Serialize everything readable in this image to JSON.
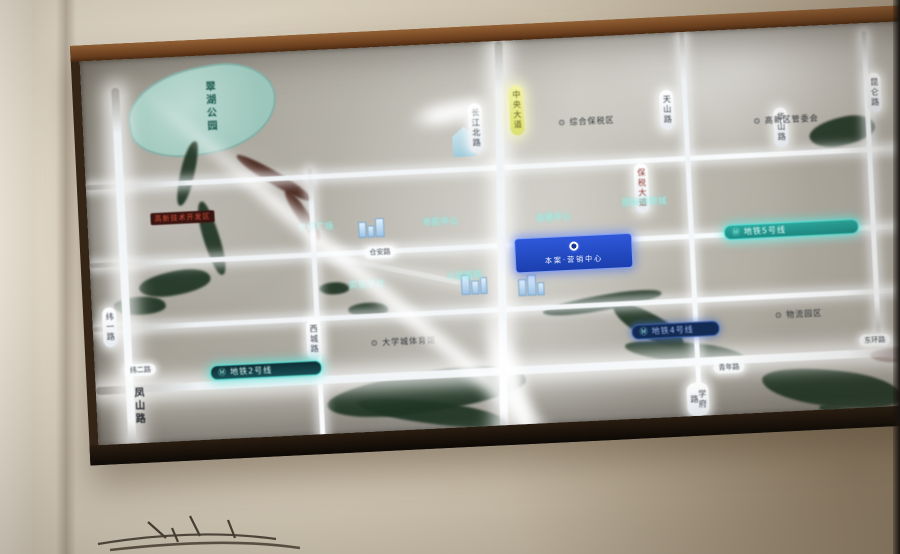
{
  "scene": {
    "type": "photo of an illuminated real-estate location map board in a wooden frame on a beige wall",
    "colors": {
      "wall": "#cfc5b2",
      "frame_wood": "#7b4b26",
      "map_base": "#b2afa6",
      "road_glow": "#f7f9fb",
      "water_green": "#213524",
      "river_red": "#45231a",
      "lake_teal": "#a9cfc5",
      "metro_teal": "#2ba79d",
      "metro_navy": "#132a52",
      "sign_blue": "#1b3fae",
      "capsule_yellow": "#e8e87a"
    }
  },
  "map": {
    "lake_label": "翠湖公园",
    "street_label_vertical": "凤山路",
    "red_banner": "高新技术开发区",
    "project_sign": {
      "icon": "ring-logo",
      "text": "本案·营销中心"
    },
    "metro_pills": [
      {
        "icon": "Ⓜ",
        "text": "地铁2号线"
      },
      {
        "icon": "Ⓜ",
        "text": "地铁5号线"
      },
      {
        "icon": "Ⓜ",
        "text": "地铁4号线"
      }
    ],
    "road_capsules": [
      {
        "text": "长江北路"
      },
      {
        "text": "中央大道"
      },
      {
        "text": "天山路"
      },
      {
        "text": "华山路"
      },
      {
        "text": "昆仑路"
      },
      {
        "text": "保税大道"
      },
      {
        "text": "西城路"
      },
      {
        "text": "纬一路"
      },
      {
        "text": "学府路"
      }
    ],
    "road_pills": [
      {
        "text": "纬二路"
      },
      {
        "text": "仓安路"
      },
      {
        "text": "青年路"
      },
      {
        "text": "东环路"
      }
    ],
    "poi_labels_teal": [
      {
        "text": "世纪广场"
      },
      {
        "text": "市民中心"
      },
      {
        "text": "会展中心"
      },
      {
        "text": "国际商贸城"
      },
      {
        "text": "实验学校"
      },
      {
        "text": "人民医院"
      }
    ],
    "poi_labels_dark": [
      {
        "text": "⊙ 大学城体育馆"
      },
      {
        "text": "⊙ 高新区管委会"
      },
      {
        "text": "⊙ 综合保税区"
      },
      {
        "text": "⊙ 物流园区"
      }
    ]
  }
}
